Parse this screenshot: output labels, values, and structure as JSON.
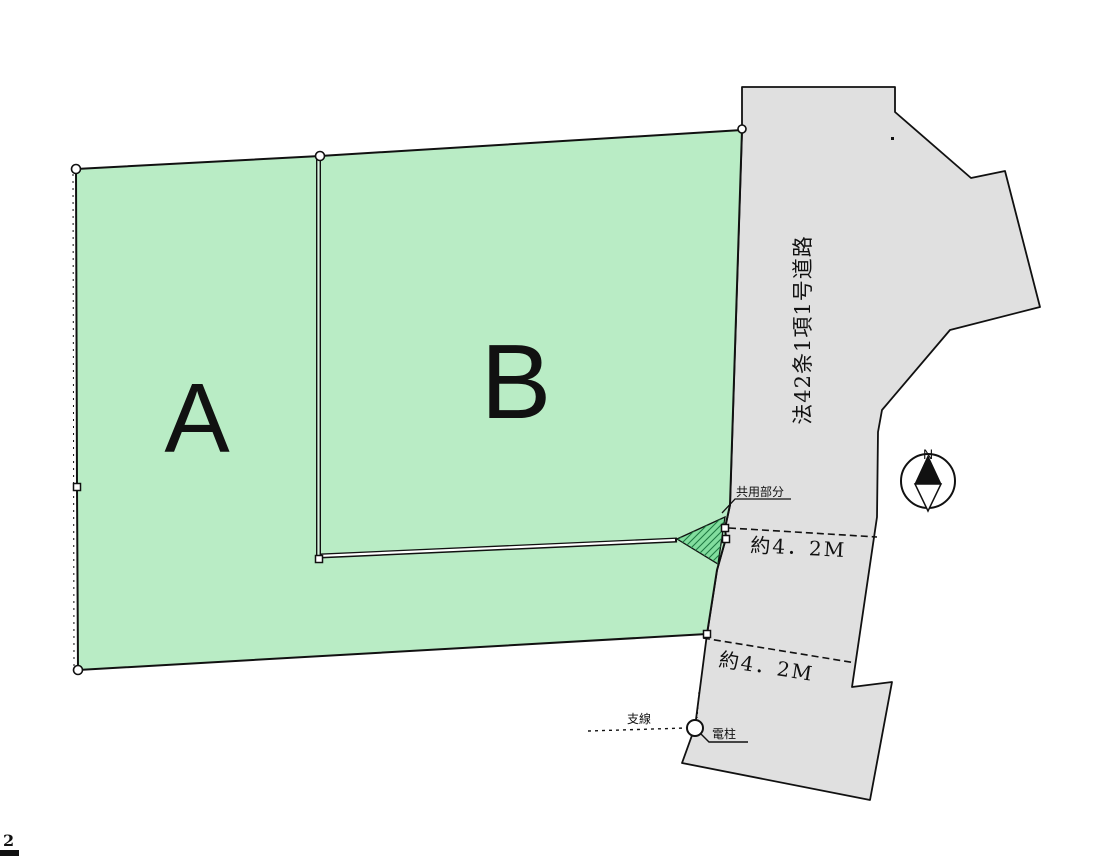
{
  "diagram": {
    "title": "land-plot-site-plan",
    "parcel_a_label": "A",
    "parcel_b_label": "B",
    "road_label": "法42条1項1号道路",
    "width_upper_label": "約4．2M",
    "width_lower_label": "約4．2M",
    "shared_area_label": "共用部分",
    "guy_wire_label": "支線",
    "utility_pole_label": "電柱",
    "compass_north_label": "N",
    "page_number": "2"
  },
  "colors": {
    "parcel_fill": "#b9ecc5",
    "shared_area_fill": "#82dd9e",
    "road_fill": "#e0e0e0",
    "line": "#111111"
  }
}
